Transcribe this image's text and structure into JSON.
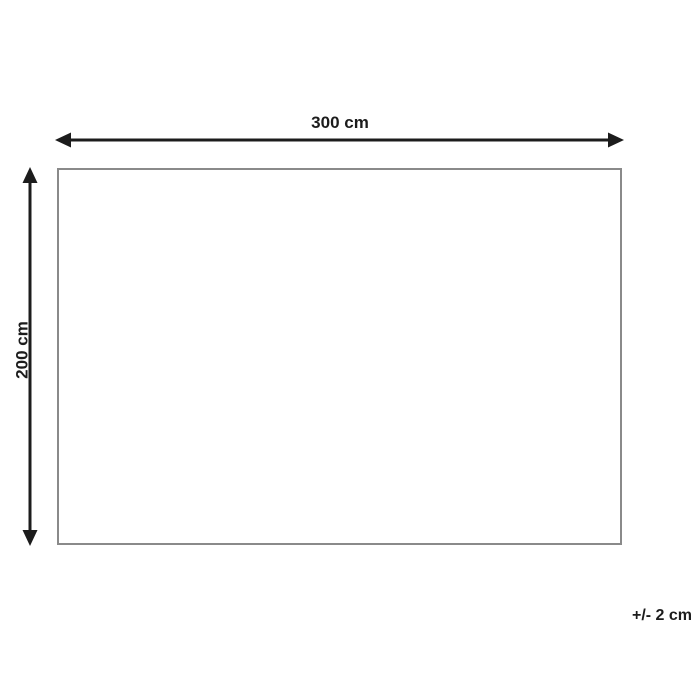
{
  "diagram": {
    "type": "dimension-drawing",
    "width_label": "300 cm",
    "height_label": "200 cm",
    "tolerance_label": "+/- 2 cm",
    "shape": {
      "kind": "rectangle",
      "width_cm": 300,
      "height_cm": 200,
      "tolerance_cm": 2
    },
    "colors": {
      "arrow": "#1c1c1c",
      "rectangle_border": "#8a8a8a",
      "background": "#ffffff",
      "text": "#1c1c1c"
    }
  }
}
